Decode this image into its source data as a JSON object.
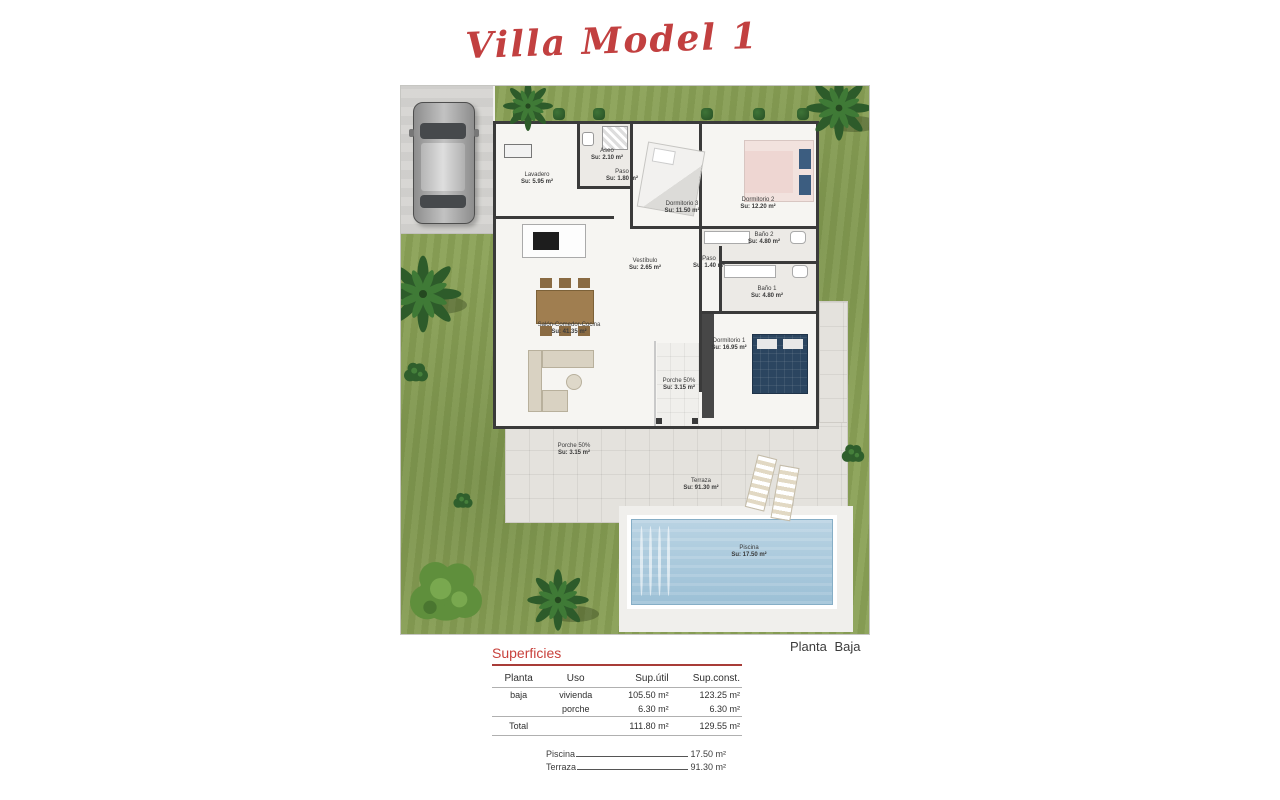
{
  "title": "Villa Model 1",
  "plan_label": "Planta Baja",
  "rooms": [
    {
      "name": "Lavadero",
      "area": "Su: 5.95 m²"
    },
    {
      "name": "Aseo",
      "area": "Su: 2.10 m²"
    },
    {
      "name": "Paso",
      "area": "Su: 1.80 m²"
    },
    {
      "name": "Dormitorio 3",
      "area": "Su: 11.50 m²"
    },
    {
      "name": "Dormitorio 2",
      "area": "Su: 12.20 m²"
    },
    {
      "name": "Baño 2",
      "area": "Su: 4.80 m²"
    },
    {
      "name": "Paso",
      "area": "Su: 1.40 m²"
    },
    {
      "name": "Baño 1",
      "area": "Su: 4.80 m²"
    },
    {
      "name": "Vestíbulo",
      "area": "Su: 2.65 m²"
    },
    {
      "name": "Salón-Comedor-Cocina",
      "area": "Su: 41.35 m²"
    },
    {
      "name": "Dormitorio 1",
      "area": "Su: 16.95 m²"
    },
    {
      "name": "Porche 50%",
      "area": "Su: 3.15 m²"
    },
    {
      "name": "Porche 50%",
      "area": "Su: 3.15 m²"
    },
    {
      "name": "Terraza",
      "area": "Su: 91.30 m²"
    },
    {
      "name": "Piscina",
      "area": "Su: 17.50 m²"
    }
  ],
  "superficies": {
    "heading": "Superficies",
    "columns": [
      "Planta",
      "Uso",
      "Sup.útil",
      "Sup.const."
    ],
    "rows": [
      [
        "baja",
        "vivienda",
        "105.50 m²",
        "123.25 m²"
      ],
      [
        "",
        "porche",
        "6.30 m²",
        "6.30 m²"
      ]
    ],
    "total_label": "Total",
    "total_util": "111.80 m²",
    "total_const": "129.55 m²"
  },
  "extras": [
    [
      "Piscina",
      "17.50 m²"
    ],
    [
      "Terraza",
      "91.30 m²"
    ]
  ],
  "colors": {
    "accent_red": "#c24040",
    "grass_green": "#8aa156",
    "pool_water": "#a9c6da",
    "wall_dark": "#3a3a3a"
  }
}
